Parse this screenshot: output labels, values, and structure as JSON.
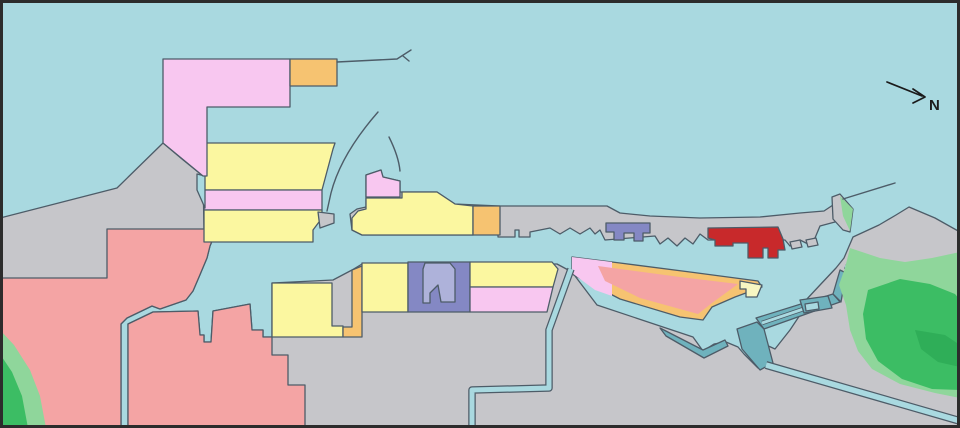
{
  "compass": {
    "label": "N"
  },
  "palette": {
    "water": "#a9d9e0",
    "land": "#c6c6ca",
    "outline": "#4d5c68",
    "frame": "#2c2c2c",
    "ink": "#1b1b1b",
    "pink": "#f8c7f0",
    "yellow": "#fbf7a0",
    "paleyellow": "#f7f6c2",
    "orange": "#f6c371",
    "salmon": "#f4a4a4",
    "red": "#c8292b",
    "purple": "#8488c4",
    "purpleLight": "#aeb2da",
    "teal": "#6fb2bd",
    "greenLight": "#8fd69b",
    "green": "#3cbd64",
    "greenDark": "#2fae58"
  },
  "map": {
    "width": 960,
    "height": 428,
    "shapes": [
      {
        "name": "sea-background",
        "type": "polygon",
        "fill": "water",
        "stroke": "none",
        "points": "0,0 960,0 960,428 0,428"
      },
      {
        "name": "land-west",
        "type": "polygon",
        "fill": "land",
        "stroke": "outline",
        "points": "0,218 117,188 163,143 182,159 203,176 204,230 217,229 210,246 207,258 199,277 193,291 186,300 160,309 152,306 127,318 121,324 121,428 0,428"
      },
      {
        "name": "land-south",
        "type": "polygon",
        "fill": "land",
        "stroke": "outline",
        "points": "128,324 153,312 198,311 200,335 204,335 204,342 211,342 213,311 250,304 252,330 263,330 263,337 272,337 272,283 333,280 352,270 362,264 557,264 572,272 597,305 693,337 703,351 714,344 726,342 738,347 744,354 758,368 770,366 960,422 960,428 128,428"
      },
      {
        "name": "land-east",
        "type": "polygon",
        "fill": "land",
        "stroke": "outline",
        "points": "853,237 879,225 896,215 909,207 935,218 960,232 960,418 772,364 757,352 764,344 775,349 790,330 800,315 806,300 820,285 836,268 844,258"
      },
      {
        "name": "zone-salmon-upper",
        "type": "polygon",
        "fill": "salmon",
        "stroke": "outline",
        "points": "107,229 217,229 210,246 207,258 199,277 193,291 186,300 160,309 152,306 127,318 121,324 121,428 0,428 0,278 107,278"
      },
      {
        "name": "zone-salmon-lower",
        "type": "polygon",
        "fill": "salmon",
        "stroke": "outline",
        "points": "128,324 153,312 198,311 200,335 204,335 204,342 211,342 213,311 250,304 252,330 263,330 263,337 272,337 272,355 288,355 288,385 305,385 305,428 128,428"
      },
      {
        "name": "green-southwest-light",
        "type": "polygon",
        "fill": "greenLight",
        "stroke": "none",
        "points": "0,330 14,345 30,370 40,396 46,428 0,428"
      },
      {
        "name": "green-southwest-dark",
        "type": "polygon",
        "fill": "green",
        "stroke": "none",
        "points": "0,354 12,372 22,396 28,428 0,428"
      },
      {
        "name": "zone-yellow-band-upper",
        "type": "polygon",
        "fill": "yellow",
        "stroke": "outline",
        "points": "204,143 335,143 333,149 322,190 204,190"
      },
      {
        "name": "zone-pink-band",
        "type": "polygon",
        "fill": "pink",
        "stroke": "outline",
        "points": "204,190 322,190 322,210 204,210"
      },
      {
        "name": "zone-yellow-band-lower",
        "type": "polygon",
        "fill": "yellow",
        "stroke": "outline",
        "points": "204,210 322,210 322,218 313,230 313,242 204,242"
      },
      {
        "name": "gray-wedge-bands",
        "type": "polygon",
        "fill": "land",
        "stroke": "outline",
        "points": "318,212 334,214 334,223 320,228"
      },
      {
        "name": "water-inlet-bands",
        "type": "polygon",
        "fill": "water",
        "stroke": "outline",
        "points": "197,174 205,176 205,208 197,190"
      },
      {
        "name": "zone-pink-north",
        "type": "polygon",
        "fill": "pink",
        "stroke": "outline",
        "points": "163,59 290,59 290,107 207,107 207,176 203,176 163,143"
      },
      {
        "name": "zone-orange-north",
        "type": "polygon",
        "fill": "orange",
        "stroke": "outline",
        "points": "290,59 337,59 337,86 290,86"
      },
      {
        "name": "breakwater-line-north",
        "type": "path",
        "stroke": "outline",
        "sw": 1.4,
        "d": "M337,62 L397,59 M397,59 L411,50 M403,56 L409,61"
      },
      {
        "name": "breakwater-arc-west",
        "type": "path",
        "stroke": "outline",
        "sw": 1.4,
        "d": "M378,112 C364,128 340,158 331,193 L327,211"
      },
      {
        "name": "breakwater-arc-east",
        "type": "path",
        "stroke": "outline",
        "sw": 1.4,
        "d": "M389,137 C395,149 399,160 400,171"
      },
      {
        "name": "zone-yellow-west-basin",
        "type": "polygon",
        "fill": "yellow",
        "stroke": "outline",
        "points": "272,283 332,283 332,326 343,326 343,337 272,337"
      },
      {
        "name": "zone-orange-strip",
        "type": "polygon",
        "fill": "orange",
        "stroke": "outline",
        "points": "352,270 362,266 362,337 343,337 343,327 352,327"
      },
      {
        "name": "zone-yellow-row2-west",
        "type": "polygon",
        "fill": "yellow",
        "stroke": "outline",
        "points": "362,263 408,263 408,312 362,312"
      },
      {
        "name": "zone-purple-row2",
        "type": "polygon",
        "fill": "purple",
        "stroke": "outline",
        "points": "408,262 470,262 470,312 408,312"
      },
      {
        "name": "zone-purple-row2-basin",
        "type": "polygon",
        "fill": "purpleLight",
        "stroke": "outline",
        "points": "425,263 450,263 455,269 455,302 441,302 438,285 430,293 430,303 423,303 423,269"
      },
      {
        "name": "zone-yellow-row2-east",
        "type": "polygon",
        "fill": "yellow",
        "stroke": "outline",
        "points": "470,262 552,262 558,269 553,287 470,287"
      },
      {
        "name": "zone-pink-row2",
        "type": "polygon",
        "fill": "pink",
        "stroke": "outline",
        "points": "470,287 553,287 547,312 470,312"
      },
      {
        "name": "peninsula-north-gray",
        "type": "polygon",
        "fill": "land",
        "stroke": "outline",
        "points": "350,214 357,209 366,207 366,175 381,170 383,177 400,181 400,192 437,192 455,204 500,206 607,206 620,213 650,216 700,218 760,217 800,213 824,211 833,205 838,200 842,212 835,222 820,226 815,238 808,244 800,240 790,246 785,240 708,240 700,234 693,244 685,238 677,246 668,238 660,244 655,236 605,240 600,230 595,234 590,228 580,234 570,228 560,234 550,228 530,232 530,237 519,237 519,230 515,230 515,237 498,237 498,230 490,230 473,235 362,235 352,230"
      },
      {
        "name": "zone-yellow-pier",
        "type": "polygon",
        "fill": "yellow",
        "stroke": "outline",
        "points": "358,211 366,209 366,198 402,198 402,192 437,192 455,204 473,206 473,235 362,235 352,230 352,218"
      },
      {
        "name": "zone-orange-pier",
        "type": "polygon",
        "fill": "orange",
        "stroke": "outline",
        "points": "473,206 500,206 500,235 473,235"
      },
      {
        "name": "zone-pink-pier",
        "type": "polygon",
        "fill": "pink",
        "stroke": "outline",
        "points": "366,197 366,175 381,170 383,177 400,181 400,197"
      },
      {
        "name": "zone-purple-peninsula",
        "type": "polygon",
        "fill": "purple",
        "stroke": "outline",
        "points": "606,223 650,223 650,233 643,233 643,241 634,241 634,233 624,233 624,240 614,240 614,232 606,232"
      },
      {
        "name": "zone-red-peninsula",
        "type": "polygon",
        "fill": "red",
        "stroke": "outline",
        "points": "708,228 778,227 783,239 785,250 778,250 778,258 768,258 768,248 763,248 763,258 748,258 748,243 733,243 733,246 715,246 715,240 708,238"
      },
      {
        "name": "dock-east-1",
        "type": "polygon",
        "fill": "land",
        "stroke": "outline",
        "points": "790,242 800,240 802,247 792,249"
      },
      {
        "name": "dock-east-2",
        "type": "polygon",
        "fill": "land",
        "stroke": "outline",
        "points": "806,240 816,238 818,245 808,247"
      },
      {
        "name": "zone-orange-south-pier",
        "type": "polygon",
        "fill": "orange",
        "stroke": "outline",
        "points": "572,257 620,263 690,272 758,281 762,287 735,297 712,307 703,320 680,317 620,299 572,274"
      },
      {
        "name": "zone-pink-south-pier",
        "type": "polygon",
        "fill": "pink",
        "stroke": "none",
        "points": "572,257 612,262 612,296 595,290 572,273"
      },
      {
        "name": "zone-salmon-south-pier",
        "type": "polygon",
        "fill": "salmon",
        "stroke": "none",
        "points": "598,266 680,277 738,284 712,303 698,314 640,298 605,281"
      },
      {
        "name": "zone-yellow-pier-tip",
        "type": "polygon",
        "fill": "paleyellow",
        "stroke": "outline",
        "points": "740,281 762,285 757,297 746,297 746,289 740,289"
      },
      {
        "name": "breakwater-teal-basin-tip",
        "type": "polygon",
        "fill": "teal",
        "stroke": "outline",
        "points": "660,328 703,350 725,340 728,346 704,358 666,336"
      },
      {
        "name": "breakwater-teal-west-arm",
        "type": "polygon",
        "fill": "teal",
        "stroke": "outline",
        "points": "737,329 757,322 764,329 773,363 760,370 742,349"
      },
      {
        "name": "breakwater-teal-north-arm",
        "type": "polygon",
        "fill": "teal",
        "stroke": "outline",
        "points": "756,318 833,294 840,302 764,329"
      },
      {
        "name": "harbor-entrance-channel",
        "type": "channel",
        "sw": 4.5,
        "iw": 2.8,
        "d": "M762,323 L830,300"
      },
      {
        "name": "breakwater-teal-link",
        "type": "polygon",
        "fill": "teal",
        "stroke": "outline",
        "points": "833,294 840,270 846,273 841,302"
      },
      {
        "name": "dock-teal-east",
        "type": "polygon",
        "fill": "teal",
        "stroke": "outline",
        "points": "800,300 828,296 832,308 804,313"
      },
      {
        "name": "dock-teal-east-basin",
        "type": "polygon",
        "fill": "water",
        "stroke": "outline",
        "points": "805,304 818,302 819,309 806,311"
      },
      {
        "name": "canal-central",
        "type": "channel",
        "sw": 7.5,
        "iw": 5,
        "d": "M571,269 L549,330 L549,388 L472,390 L472,428"
      },
      {
        "name": "canal-southeast",
        "type": "channel",
        "sw": 8,
        "iw": 5.5,
        "d": "M766,365 L960,421"
      },
      {
        "name": "channel-east-jetty",
        "type": "channel",
        "sw": 5,
        "iw": 3,
        "d": "M845,266 L877,281"
      },
      {
        "name": "island-parallelogram",
        "type": "polygon",
        "fill": "land",
        "stroke": "outline",
        "points": "832,197 840,194 853,209 850,232 843,230 833,219"
      },
      {
        "name": "island-parallelogram-green",
        "type": "polygon",
        "fill": "greenLight",
        "stroke": "none",
        "points": "840,196 853,209 850,231 843,216"
      },
      {
        "name": "pier-line-northeast",
        "type": "path",
        "stroke": "outline",
        "sw": 1.4,
        "d": "M843,199 L895,183"
      },
      {
        "name": "green-hill-light",
        "type": "polygon",
        "fill": "greenLight",
        "stroke": "none",
        "points": "850,248 880,258 905,262 932,258 960,252 960,398 935,393 900,384 872,369 858,351 850,330 846,305 839,285 845,268"
      },
      {
        "name": "green-hill-mid",
        "type": "polygon",
        "fill": "green",
        "stroke": "none",
        "points": "868,290 900,279 930,284 955,294 960,300 960,390 932,389 902,379 878,361 866,339 863,314"
      },
      {
        "name": "green-hill-dark",
        "type": "polygon",
        "fill": "greenDark",
        "stroke": "none",
        "points": "915,330 945,335 960,345 960,367 938,362 921,349"
      },
      {
        "name": "north-arrow",
        "type": "path",
        "stroke": "ink",
        "sw": 1.7,
        "d": "M887,82 L922,96 M913,89 L925,97 L913,103"
      },
      {
        "name": "north-label",
        "type": "text",
        "x": 929,
        "y": 110,
        "fill": "ink",
        "bind": "compass.label"
      },
      {
        "name": "map-frame",
        "type": "framerect",
        "stroke": "frame",
        "sw": 6
      }
    ]
  }
}
